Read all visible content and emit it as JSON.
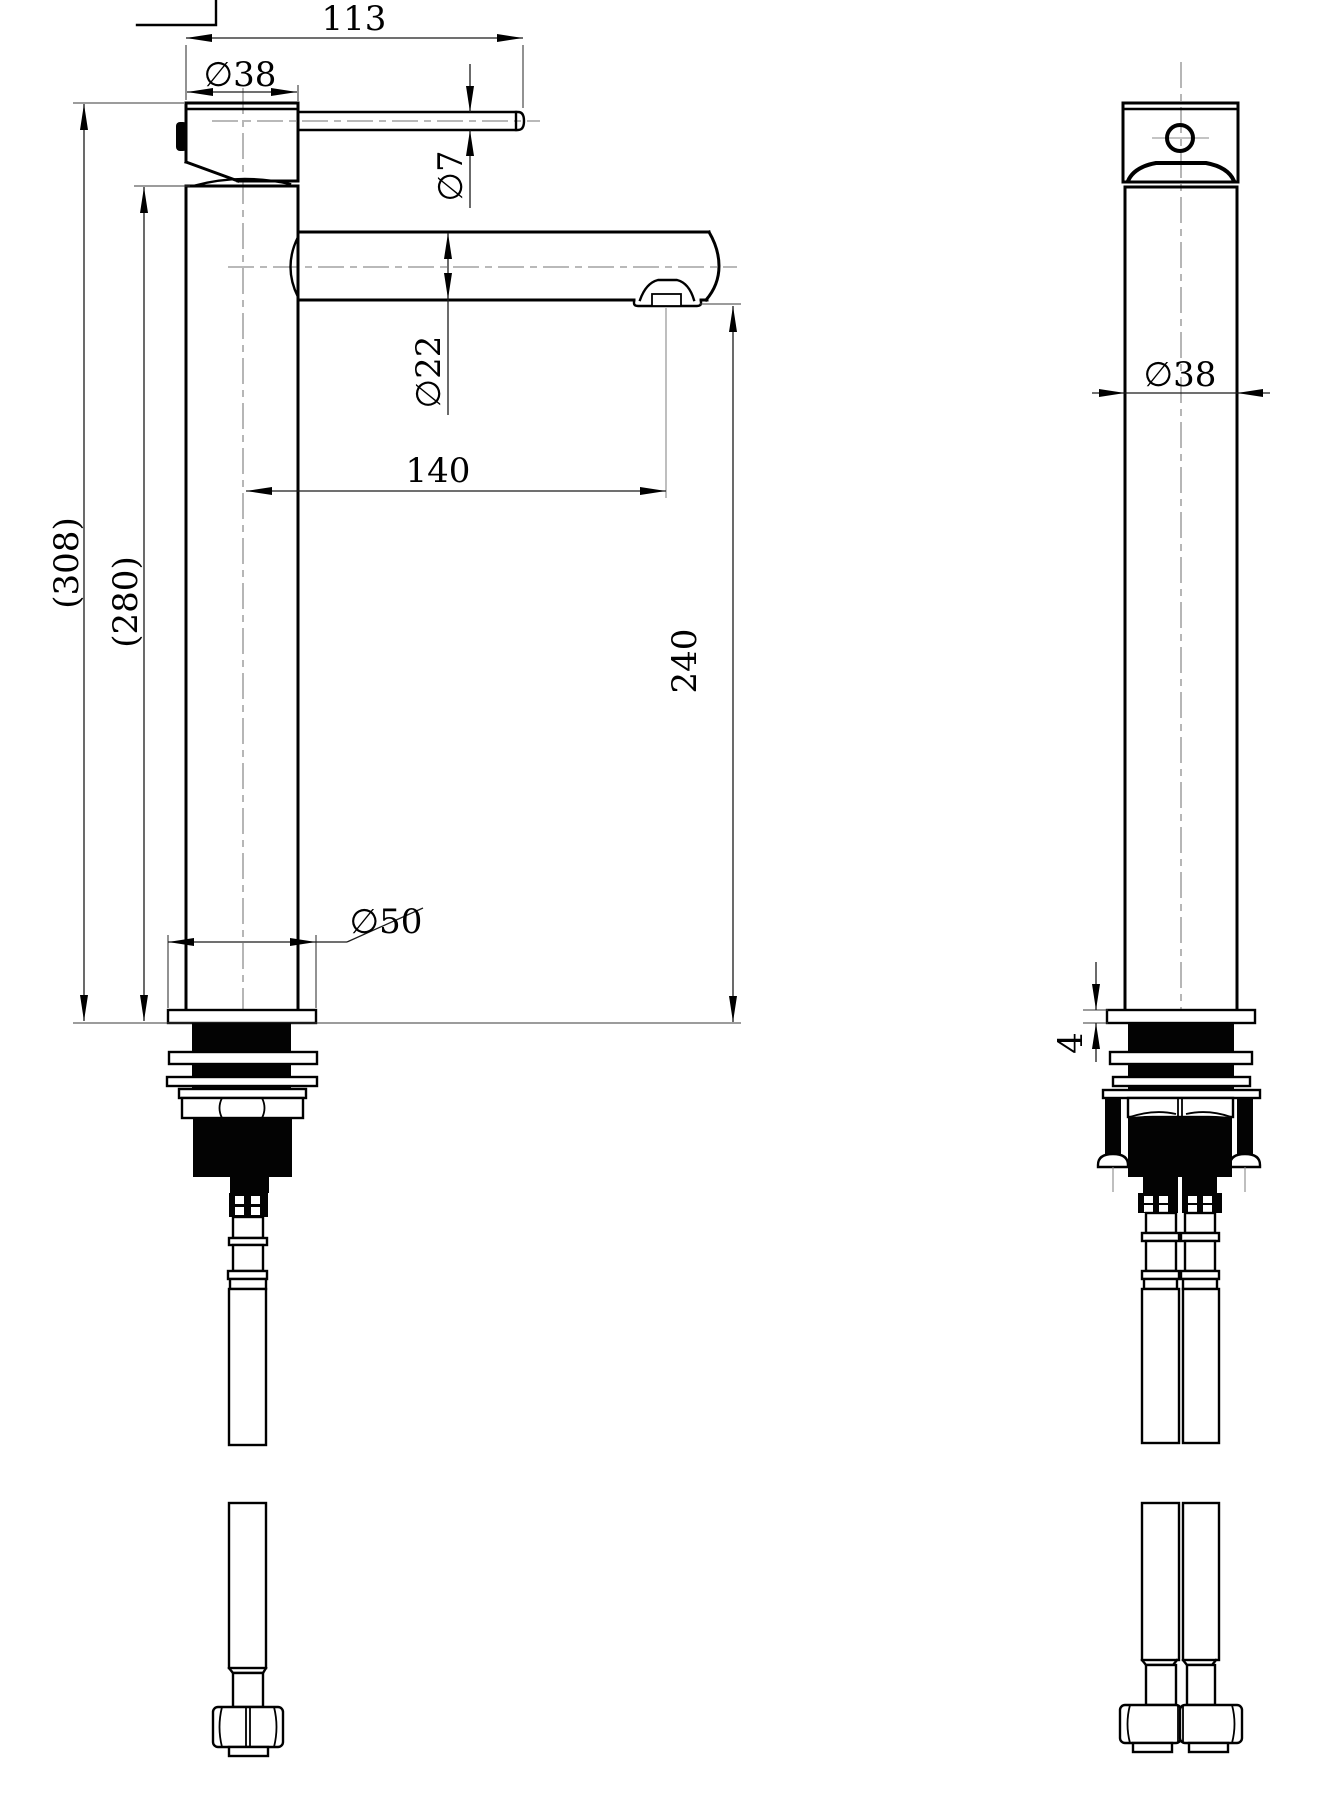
{
  "drawing": {
    "kind": "technical-drawing",
    "background": "#ffffff",
    "line_color": "#000000",
    "centerline_color": "#8f8f8f",
    "dimensions": {
      "lever_length": "113",
      "handle_head_diameter": "∅38",
      "lever_diameter": "∅7",
      "spout_tube_diameter": "∅22",
      "spout_reach": "140",
      "outlet_height": "240",
      "overall_height": "(308)",
      "body_height": "(280)",
      "base_flange_diameter": "∅50",
      "front_body_diameter": "∅38",
      "flange_thickness": "4"
    }
  }
}
